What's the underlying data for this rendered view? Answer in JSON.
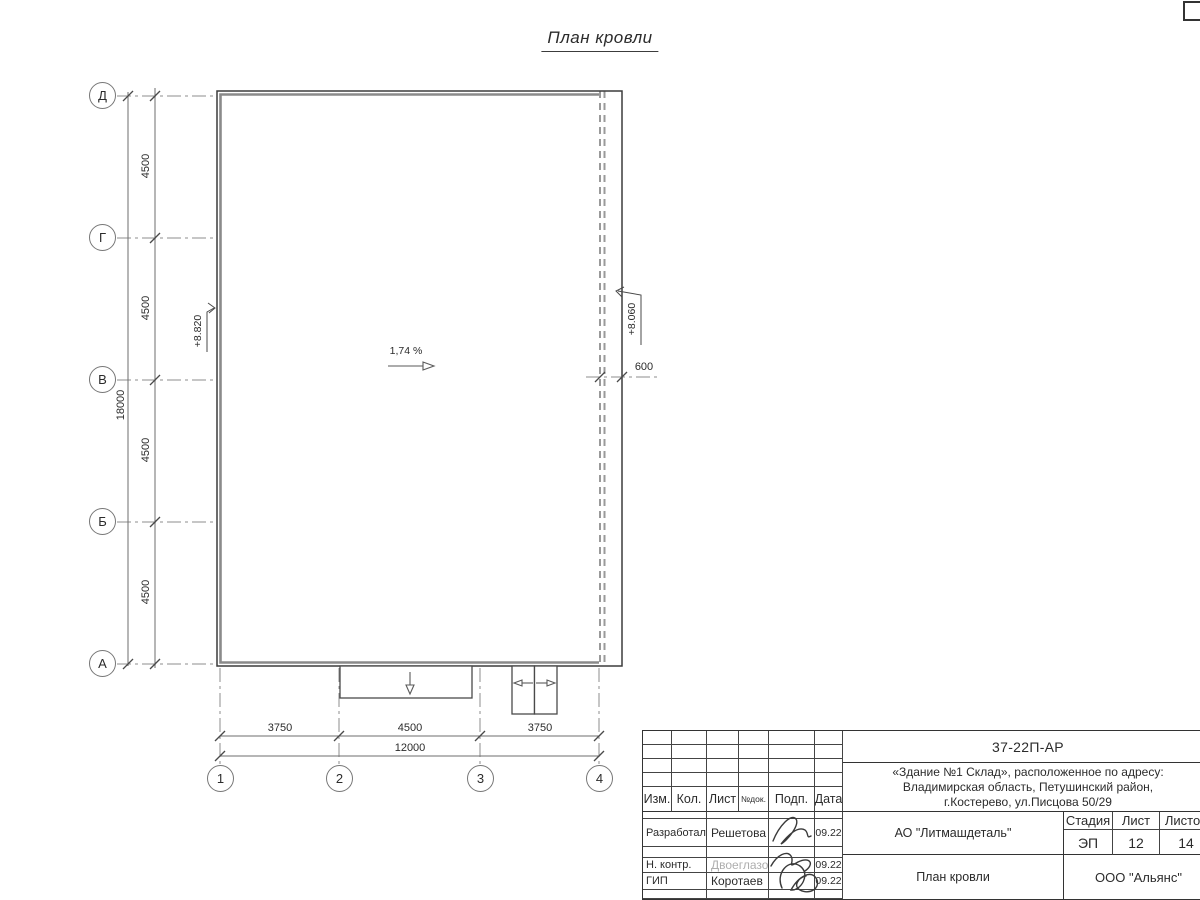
{
  "title": "План кровли",
  "colors": {
    "main_line": "#3c3c3c",
    "parapet_line": "#8a8a8a",
    "dashed_wall": "#9a9a9a",
    "dim_line": "#6e6e6e",
    "text": "#2b2b2b",
    "muted_text": "#aeaeae"
  },
  "axes": {
    "vertical": [
      "Д",
      "Г",
      "В",
      "Б",
      "А"
    ],
    "horizontal": [
      "1",
      "2",
      "3",
      "4"
    ]
  },
  "dimensions": {
    "left_segments": [
      "4500",
      "4500",
      "4500",
      "4500"
    ],
    "left_total": "18000",
    "bottom_segments": [
      "3750",
      "4500",
      "3750"
    ],
    "bottom_total": "12000",
    "roof_overhang": "600"
  },
  "annotations": {
    "elevation_left": "+8.820",
    "elevation_right": "+8.060",
    "main_slope": "1,74 %",
    "canopy_slope_main": "26,8%",
    "canopy_slope_left": "26,6%",
    "canopy_slope_right": "26,6%"
  },
  "title_block": {
    "doc_number": "37-22П-АР",
    "address_line1": "«Здание №1 Склад», расположенное по адресу:",
    "address_line2": "Владимирская область, Петушинский район,",
    "address_line3": "г.Костерево, ул.Писцова 50/29",
    "header": {
      "izm": "Изм.",
      "kol": "Кол.",
      "list": "Лист",
      "ndok": "№док.",
      "podp": "Подп.",
      "data": "Дата"
    },
    "rows": [
      {
        "role": "Разработал",
        "name": "Решетова",
        "date": "09.22"
      },
      {
        "role": "Н. контр.",
        "name": "Двоеглазов",
        "date": "09.22"
      },
      {
        "role": "ГИП",
        "name": "Коротаев",
        "date": "09.22"
      }
    ],
    "company": "АО \"Литмашдеталь\"",
    "stage_label": "Стадия",
    "sheet_label": "Лист",
    "sheets_label": "Листов",
    "stage": "ЭП",
    "sheet": "12",
    "sheets": "14",
    "drawing_title": "План кровли",
    "org": "ООО \"Альянс\""
  }
}
